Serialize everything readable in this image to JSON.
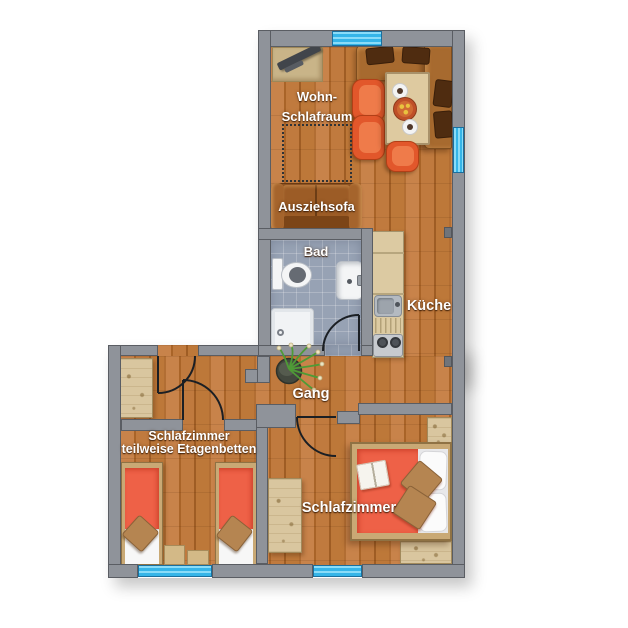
{
  "title": "Apartment floor plan",
  "labels": {
    "living_room": [
      "Wohn-",
      "Schlafraum"
    ],
    "sofa_bed": "Ausziehsofa",
    "bathroom": "Bad",
    "kitchen": "Küche",
    "hallway": "Gang",
    "bedroom_bunks": [
      "Schlafzimmer",
      "teilweise Etagenbetten"
    ],
    "bedroom_double": "Schlafzimmer"
  },
  "colors": {
    "wall_fill": "#8f939a",
    "wall_outline": "#5a5d63",
    "window_blue": "#35b5e8",
    "floor_wood": "#bf7a3c",
    "bathroom_tile": "#97a2b4",
    "bed_cover_orange": "#ee6147",
    "sofa_brown": "#9c5c26",
    "pine_wood": "#d9c69f",
    "label_text": "#ffffff"
  },
  "furniture": [
    "tv-sideboard",
    "corner-bench",
    "dining-table",
    "dining-chairs",
    "plates",
    "sofa-bed",
    "fold-out-area",
    "toilet",
    "washbasin",
    "shower",
    "kitchenette-sink",
    "kitchenette-stove",
    "houseplant",
    "hall-wardrobe",
    "single-bed",
    "single-bed",
    "nightstands",
    "bedroom-wardrobe",
    "double-bed",
    "pillows",
    "cushions",
    "open-book",
    "wall-shelves"
  ]
}
